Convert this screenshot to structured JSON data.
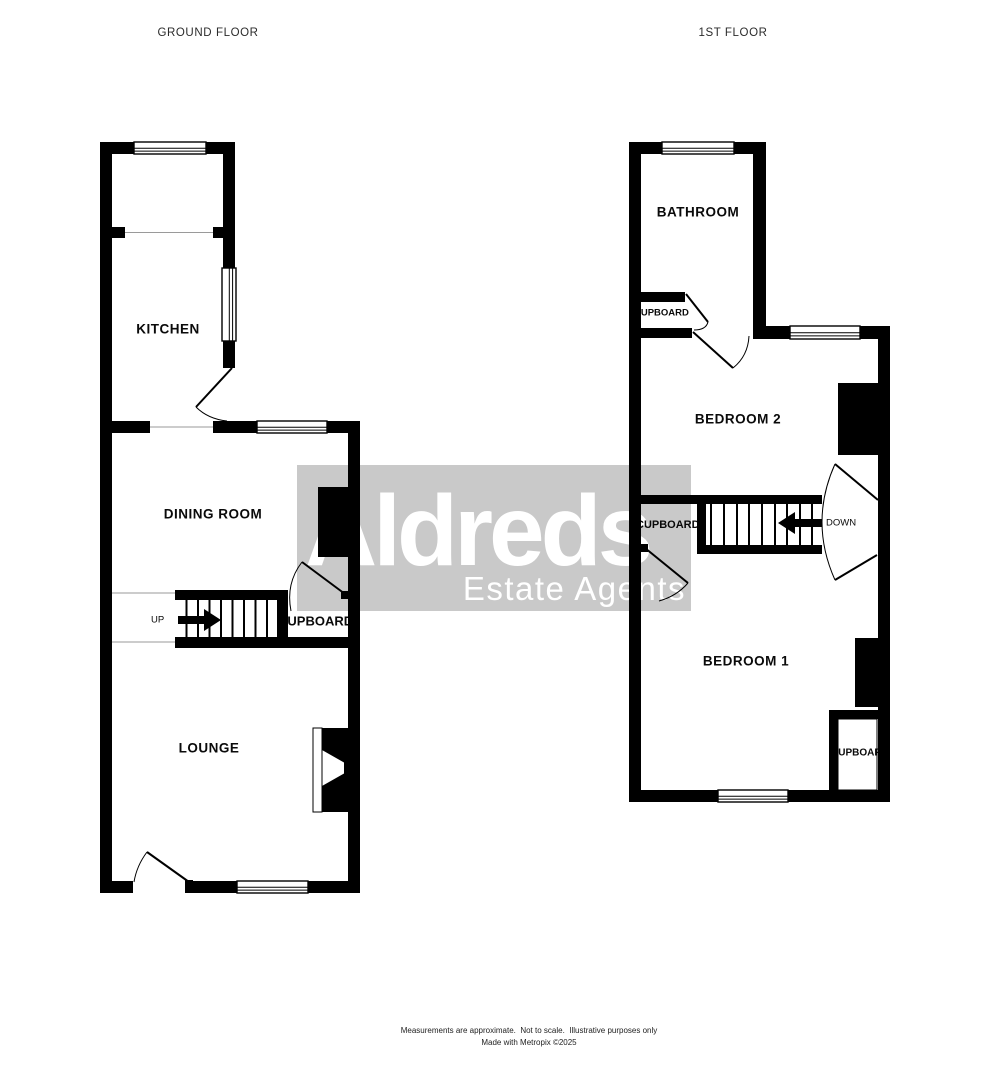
{
  "ground_floor": {
    "title": "GROUND FLOOR",
    "rooms": {
      "kitchen": "KITCHEN",
      "dining_room": "DINING ROOM",
      "lounge": "LOUNGE"
    },
    "cupboard_label": "CUPBOARD",
    "stairs_direction": "UP"
  },
  "first_floor": {
    "title": "1ST FLOOR",
    "rooms": {
      "bathroom": "BATHROOM",
      "bedroom_2": "BEDROOM 2",
      "bedroom_1": "BEDROOM 1"
    },
    "cupboard_labels": {
      "bathroom": "CUPBOARD",
      "landing": "CUPBOARD",
      "bedroom_1": "CUPBOARD"
    },
    "stairs_direction": "DOWN"
  },
  "watermark": {
    "brand": "Aldreds",
    "tagline": "Estate Agents",
    "panel_color": "#c9c9c9",
    "text_color": "#ffffff"
  },
  "footer": {
    "line1": "Measurements are approximate.  Not to scale.  Illustrative purposes only",
    "line2": "Made with Metropix ©2025"
  },
  "colors": {
    "wall": "#000000",
    "background": "#ffffff"
  }
}
